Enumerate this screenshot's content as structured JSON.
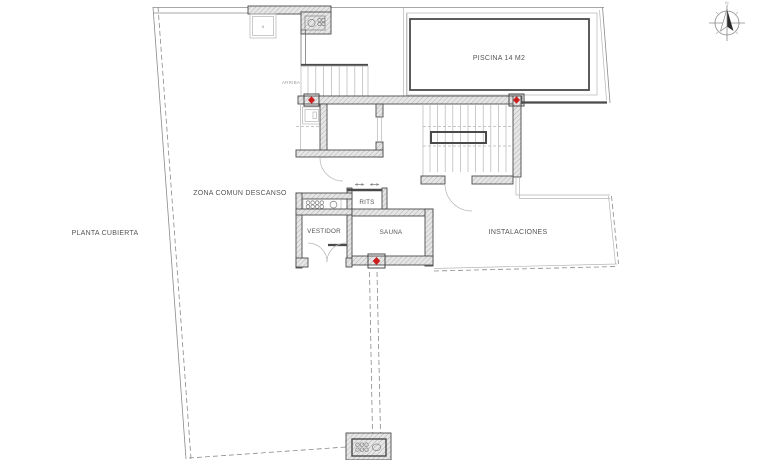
{
  "plan": {
    "labels": {
      "pool": "PISCINA 14 M2",
      "common_area": "ZONA COMUN DESCANSO",
      "roof_level": "PLANTA CUBIERTA",
      "dressing_room": "VESTIDOR",
      "sauna": "SAUNA",
      "rits": "RITS",
      "installations": "INSTALACIONES",
      "stairs_up": "ARRIBA",
      "skylight_mark": "a",
      "north": "N"
    },
    "colors": {
      "background": "#ffffff",
      "wall_line": "#4a4a4a",
      "wall_fill": "#e6e6e6",
      "hatch_line": "#9c9c9c",
      "thin_line": "#8a8a8a",
      "light_line": "#b5b5b5",
      "marker_red": "#cc1d1d",
      "text": "#555555",
      "faint_text": "#a0a0a0"
    }
  }
}
